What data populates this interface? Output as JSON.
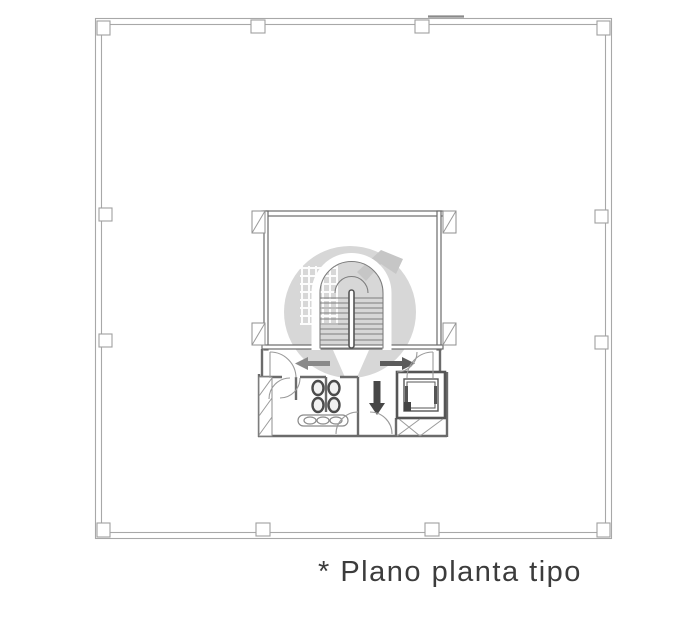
{
  "page": {
    "width": 692,
    "height": 634,
    "background": "#ffffff"
  },
  "caption": {
    "text": "* Plano planta tipo",
    "color": "#3c3c3c"
  },
  "watermark": {
    "shape": "circle-logo",
    "circle_color": "#d7d7d7",
    "accent_color": "#c6c6c6",
    "grid_color": "#ffffff",
    "tail_color": "#ffffff"
  },
  "plan": {
    "title": "Plano planta tipo",
    "wall_color": "#a8a8a8",
    "core_wall_color": "#6b6b6b",
    "arrows": {
      "left": {
        "direction": "left",
        "color": "#8a8a8a"
      },
      "right": {
        "direction": "right",
        "color": "#5c5c5c"
      },
      "down": {
        "direction": "down",
        "color": "#474747"
      }
    },
    "fixtures": {
      "toilet_count": 4,
      "sink_count": 3,
      "elevator_count": 1,
      "stair_flights": 2
    }
  }
}
